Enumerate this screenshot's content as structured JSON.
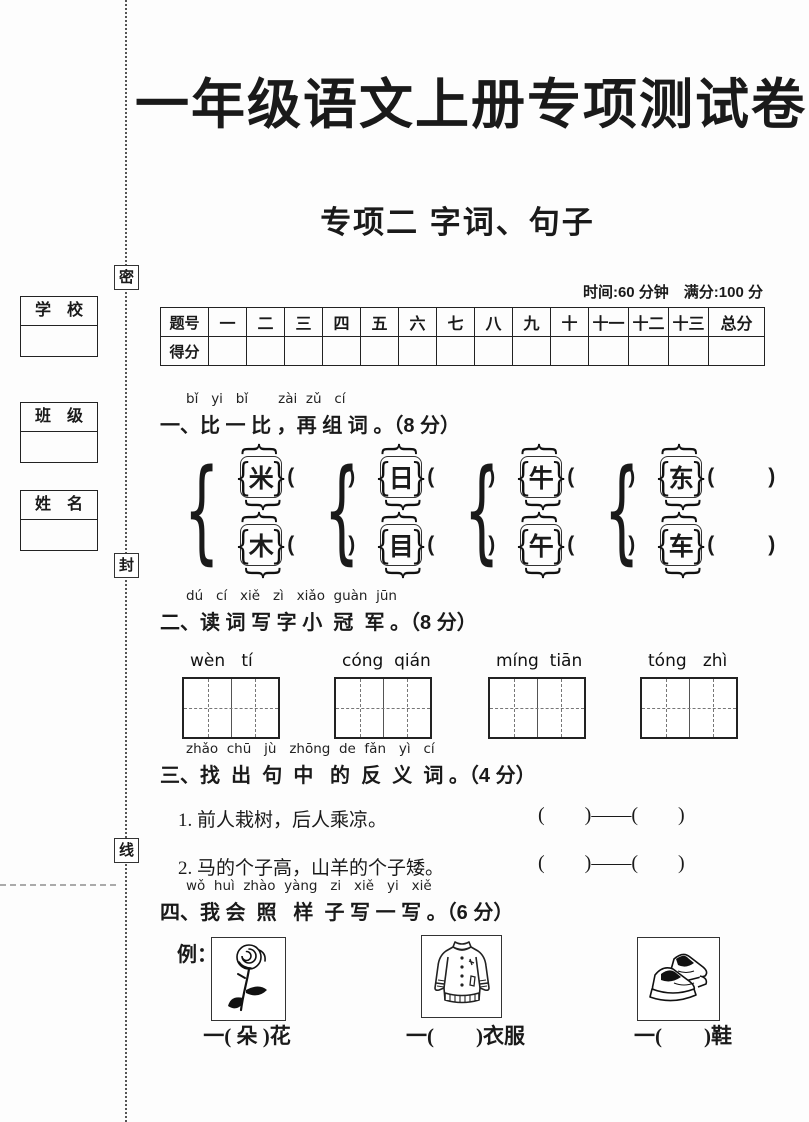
{
  "page": {
    "title": "一年级语文上册专项测试卷",
    "subtitle": "专项二 字词、句子",
    "time_info": "时间:60 分钟　满分:100 分"
  },
  "margin": {
    "seal_chars": [
      "密",
      "封",
      "线"
    ],
    "fields": [
      {
        "label": "学　校"
      },
      {
        "label": "班　级"
      },
      {
        "label": "姓　名"
      }
    ]
  },
  "score_table": {
    "header": [
      "题号",
      "一",
      "二",
      "三",
      "四",
      "五",
      "六",
      "七",
      "八",
      "九",
      "十",
      "十一",
      "十二",
      "十三",
      "总分"
    ],
    "row_label": "得分"
  },
  "decor": {
    "group_brace": "{",
    "brace_open": "{",
    "brace_close": "}",
    "paren_open": "(",
    "paren_close": ")"
  },
  "q1": {
    "pinyin": "bǐ   yi   bǐ       zài  zǔ   cí",
    "title": "一、比 一 比 ，再 组 词 。（8 分）",
    "pairs": [
      [
        "米",
        "木"
      ],
      [
        "日",
        "目"
      ],
      [
        "牛",
        "午"
      ],
      [
        "东",
        "车"
      ]
    ]
  },
  "q2": {
    "pinyin": "dú   cí   xiě   zì   xiǎo  guàn  jūn",
    "title": "二、读 词 写 字 小  冠  军 。（8 分）",
    "words": [
      "wèn   tí",
      "cóng  qián",
      "míng  tiān",
      "tóng   zhì"
    ]
  },
  "q3": {
    "pinyin": "zhǎo  chū   jù   zhōng  de  fǎn   yì   cí",
    "title": "三、找  出  句  中   的  反  义  词 。（4 分）",
    "items": [
      "1. 前人栽树，后人乘凉。",
      "2. 马的个子高，山羊的个子矮。"
    ],
    "blank": "(        )——(        )"
  },
  "q4": {
    "pinyin": "wǒ  huì  zhào  yàng   zi   xiě   yi   xiě",
    "title": "四、我 会  照   样  子 写 一 写 。（6 分）",
    "example_label": "例：",
    "items": [
      {
        "image": "rose",
        "caption": "一( 朵 )花"
      },
      {
        "image": "jacket",
        "caption": "一(　　)衣服"
      },
      {
        "image": "shoes",
        "caption": "一(　　)鞋"
      }
    ]
  }
}
